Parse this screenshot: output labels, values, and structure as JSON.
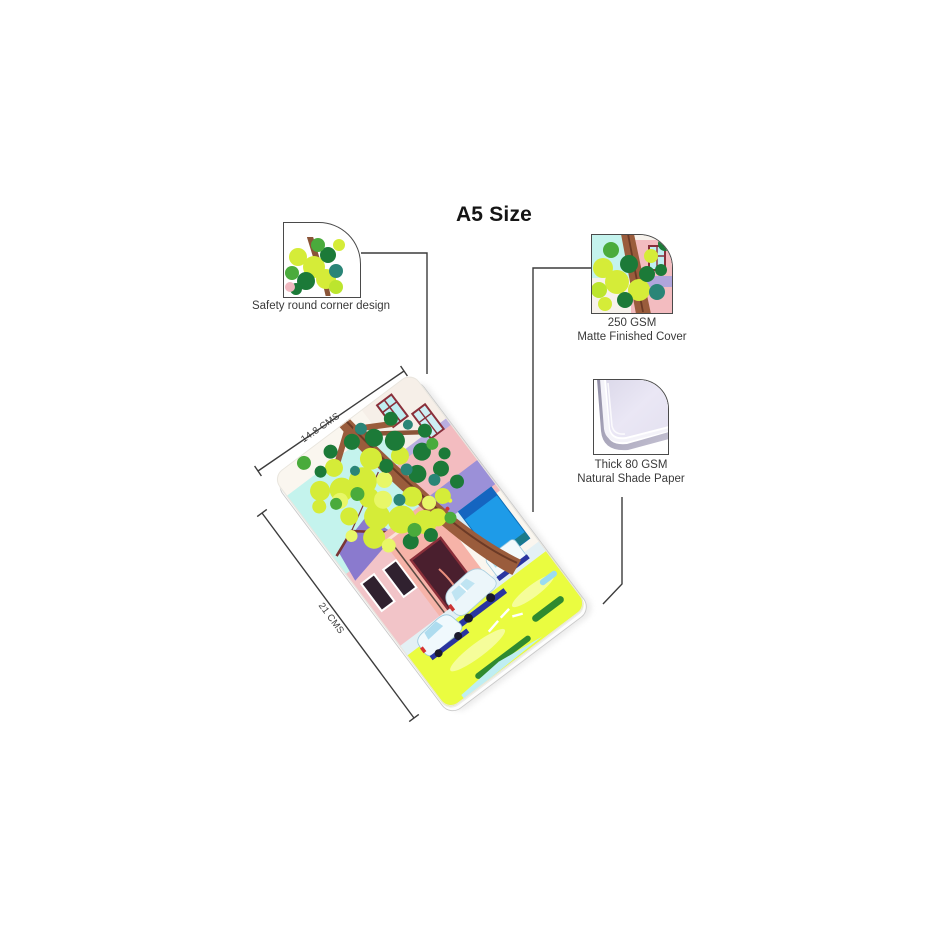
{
  "title": "A5 Size",
  "callouts": {
    "round_corner": {
      "caption": "Safety round corner design"
    },
    "cover": {
      "line1": "250 GSM",
      "line2": "Matte Finished Cover"
    },
    "paper": {
      "line1": "Thick 80 GSM",
      "line2": "Natural Shade Paper"
    }
  },
  "dimensions": {
    "width": "14.8 CMS",
    "height": "21 CMS"
  },
  "colors": {
    "sky": "#c4f3ed",
    "foliage_light": "#d5ec38",
    "foliage_dark": "#1c7a38",
    "foliage_teal": "#2a8577",
    "trunk_brown": "#9a5c3c",
    "house_pink": "#f3bcc0",
    "roof_purple": "#8a7ace",
    "door_blue": "#1e9be8",
    "wall_lavender": "#9b90d8",
    "road_green": "#eafc40",
    "car_shadow_navy": "#2a35a0",
    "paper_shade": "#e9e6f3",
    "line": "#3c3c3c"
  }
}
